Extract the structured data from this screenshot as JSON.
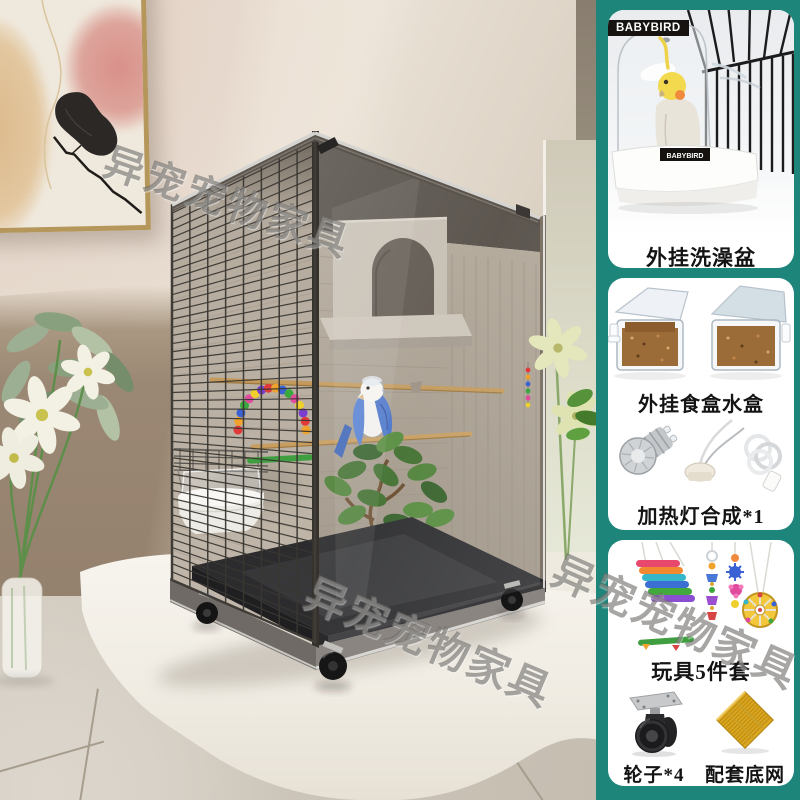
{
  "watermark": {
    "text": "异宠宠物家具"
  },
  "colors": {
    "panel_bg": "#1d857a",
    "card_bg": "#ffffff",
    "caption_color": "#141414",
    "badge_bg": "#171310",
    "badge_text": "#ffffff",
    "mesh_gold": "#d9a61f"
  },
  "panel": {
    "cards": [
      {
        "name": "bath-box",
        "brand_badge": "BABYBIRD",
        "product_label": "BABYBIRD",
        "caption": "外挂洗澡盆"
      },
      {
        "name": "feeder-and-lamp",
        "caption_feeder": "外挂食盒水盒",
        "caption_lamp": "加热灯合成*1"
      },
      {
        "name": "toys-and-parts",
        "caption_toys": "玩具5件套",
        "caption_wheels": "轮子*4",
        "caption_mesh": "配套底网*1"
      }
    ]
  }
}
